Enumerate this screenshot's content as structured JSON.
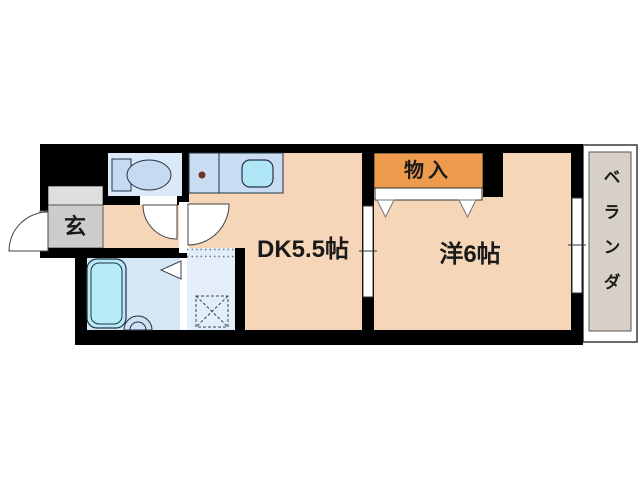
{
  "floorplan": {
    "title": "apartment-floor-plan-1dk",
    "rooms": {
      "genkan": {
        "label": "玄"
      },
      "dining_kitchen": {
        "label": "DK5.5帖"
      },
      "closet": {
        "label": "物入"
      },
      "western_room": {
        "label": "洋6帖"
      },
      "veranda": {
        "label": "ベランダ"
      }
    },
    "colors": {
      "wall": "#000000",
      "floor": "#f5d6b8",
      "closet": "#ef9b4e",
      "genkan_step": "#dedede",
      "genkan_floor": "#cccccc",
      "toilet_room": "#dbe8f8",
      "bathroom": "#d7e6f5",
      "laundry_room": "#e3eefa",
      "counter": "#c9ddf2",
      "fixture": "#c6daf1",
      "sink": "#aee6f5",
      "bathtub": "#b6ebf7",
      "basin": "#cfe2f4",
      "veranda": "#d6d0c6",
      "burner": "#6e3428",
      "door_white": "#ffffff"
    }
  }
}
